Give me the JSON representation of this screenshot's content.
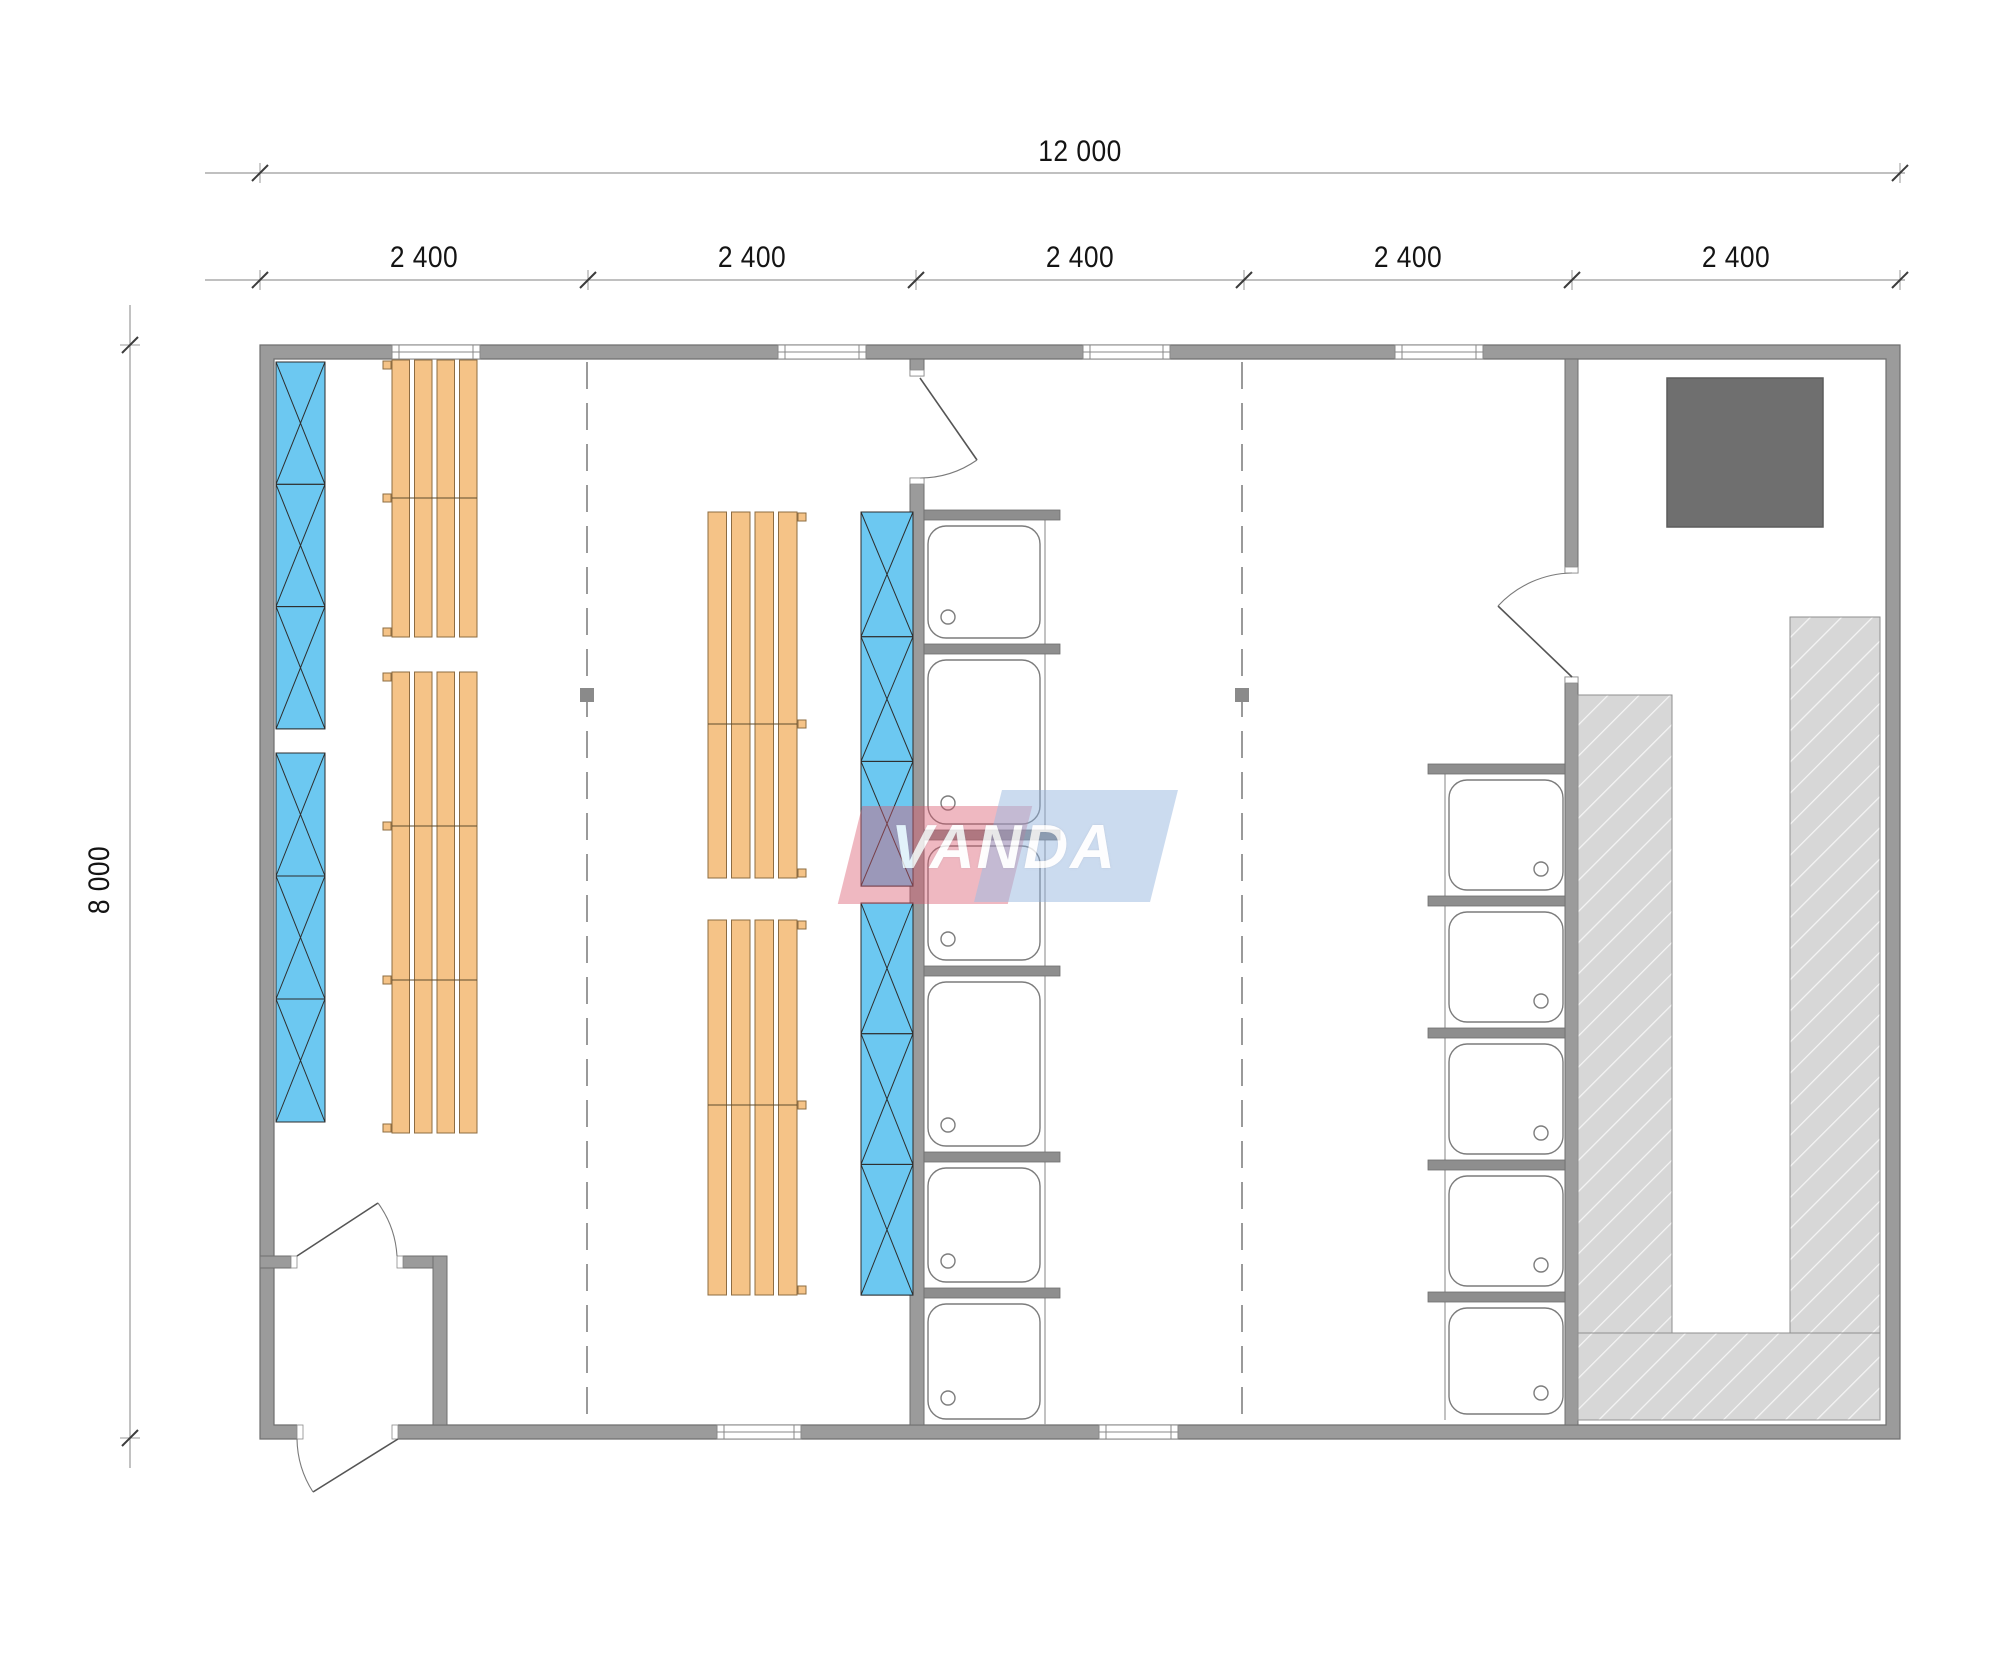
{
  "brand": {
    "name": "VANDA"
  },
  "dimensions": {
    "total": "12 000",
    "module": "2 400",
    "height": "8 000"
  },
  "colors": {
    "wall": "#9b9b9b",
    "wall_edge": "#6f6f6f",
    "partition": "#8e8e8e",
    "tray_edge": "#7c7c7c",
    "front_line": "#9a9a9a",
    "blue_fill": "#6cc8f1",
    "blue_edge": "#34718f",
    "blue_line": "#2d2d2d",
    "orange_fill": "#f5c387",
    "orange_edge": "#8d6c42",
    "orange_divider": "#5f4c2e",
    "bench_fill": "#d7d7d7",
    "bench_edge": "#8f8f8f",
    "stove_fill": "#6f6f6f",
    "stove_edge": "#5c5c5c",
    "dim_line": "#9a9a9a",
    "dim_tick": "#3c3c3c",
    "door_line": "#555555",
    "arc_line": "#7a7a7a",
    "dashed": "#9a9a9a",
    "post": "#8a8a8a",
    "white": "#ffffff"
  },
  "plan": {
    "outer": {
      "x": 260,
      "y": 345,
      "w": 1640,
      "h": 1094,
      "t": 14
    },
    "walls": [
      [
        910,
        359,
        14,
        17
      ],
      [
        910,
        478,
        14,
        947
      ],
      [
        1565,
        359,
        13,
        214
      ],
      [
        1565,
        677,
        13,
        748
      ],
      [
        260,
        1256,
        31,
        12
      ],
      [
        403,
        1256,
        44,
        12
      ],
      [
        433,
        1256,
        14,
        169
      ]
    ],
    "wall_gaps_white": [
      [
        297,
        1424,
        101,
        16
      ]
    ],
    "jambs": [
      [
        910,
        370,
        14,
        6
      ],
      [
        910,
        478,
        14,
        6
      ],
      [
        1565,
        567,
        13,
        6
      ],
      [
        1565,
        677,
        13,
        6
      ],
      [
        291,
        1256,
        6,
        12
      ],
      [
        397,
        1256,
        6,
        12
      ],
      [
        297,
        1425,
        6,
        14
      ],
      [
        392,
        1425,
        6,
        14
      ]
    ],
    "top_windows": [
      [
        392,
        88
      ],
      [
        778,
        88
      ],
      [
        1083,
        87
      ],
      [
        1395,
        88
      ]
    ],
    "bottom_windows": [
      [
        717,
        84
      ],
      [
        1099,
        79
      ]
    ],
    "dashed_x": [
      587,
      1242
    ],
    "dashed_y1": 362,
    "dashed_y2": 1424,
    "posts": [
      [
        580,
        688,
        14
      ],
      [
        1235,
        688,
        14
      ]
    ],
    "orange_groups": [
      {
        "x": 392,
        "y": 360,
        "w": 85,
        "h": 277,
        "div": [
          498
        ],
        "tab": "left"
      },
      {
        "x": 392,
        "y": 672,
        "w": 85,
        "h": 461,
        "div": [
          826,
          980
        ],
        "tab": "left"
      },
      {
        "x": 708,
        "y": 512,
        "w": 89,
        "h": 366,
        "div": [
          724
        ],
        "tab": "right"
      },
      {
        "x": 708,
        "y": 920,
        "w": 89,
        "h": 375,
        "div": [
          1105
        ],
        "tab": "right"
      }
    ],
    "blue_panels": [
      {
        "x": 276,
        "y": 362,
        "w": 49,
        "n": 3,
        "bh": 122.3
      },
      {
        "x": 276,
        "y": 753,
        "w": 49,
        "n": 3,
        "bh": 123
      },
      {
        "x": 861,
        "y": 512,
        "w": 52,
        "n": 3,
        "bh": 124.7
      },
      {
        "x": 861,
        "y": 903,
        "w": 52,
        "n": 3,
        "bh": 130.7
      }
    ],
    "stall_columns": [
      {
        "bars_y": [
          510,
          644,
          830,
          966,
          1152,
          1288
        ],
        "bar_x": 924,
        "bar_w": 136,
        "bar_h": 10,
        "tray_x": 928,
        "tray_w": 112,
        "front_x": 1045,
        "drain_cx": 948,
        "bottom": 1425
      },
      {
        "bars_y": [
          764,
          896,
          1028,
          1160,
          1292
        ],
        "bar_x": 1428,
        "bar_w": 137,
        "bar_h": 10,
        "tray_x": 1449,
        "tray_w": 114,
        "front_x": 1445,
        "drain_cx": 1541,
        "bottom": 1420
      }
    ],
    "sauna": {
      "stove": [
        1667,
        378,
        156,
        149
      ],
      "benches": [
        [
          1578,
          695,
          94,
          638
        ],
        [
          1790,
          617,
          90,
          716
        ],
        [
          1578,
          1333,
          302,
          87
        ]
      ]
    },
    "doors": [
      {
        "leaf": [
          [
            920,
            378
          ],
          [
            977,
            460
          ]
        ],
        "arc": "M 920,478 A 100 100 0 0 0 977,460"
      },
      {
        "leaf": [
          [
            297,
            1256
          ],
          [
            378,
            1203
          ]
        ],
        "arc": "M 397,1256 A 100 100 0 0 0 378,1203"
      },
      {
        "leaf": [
          [
            398,
            1439
          ],
          [
            313,
            1492
          ]
        ],
        "arc": "M 297,1439 A 101 101 0 0 0 313,1492"
      },
      {
        "leaf": [
          [
            1572,
            677
          ],
          [
            1498,
            606
          ]
        ],
        "arc": "M 1572,573 A 103 103 0 0 0 1498,606"
      }
    ],
    "dims": {
      "top_total": {
        "y": 173,
        "line_x1": 205,
        "line_x2": 1905,
        "ticks": [
          260,
          1900
        ],
        "label_x": 1080,
        "label_y": 152
      },
      "top_modules": {
        "y": 280,
        "line_x1": 205,
        "line_x2": 1905,
        "ticks": [
          260,
          588,
          916,
          1244,
          1572,
          1900
        ],
        "label_y": 258,
        "label_xs": [
          424,
          752,
          1080,
          1408,
          1736
        ]
      },
      "left": {
        "x": 130,
        "line_y1": 305,
        "line_y2": 1468,
        "ticks": [
          345,
          1438
        ],
        "label_x": 100,
        "label_y": 880
      }
    }
  }
}
